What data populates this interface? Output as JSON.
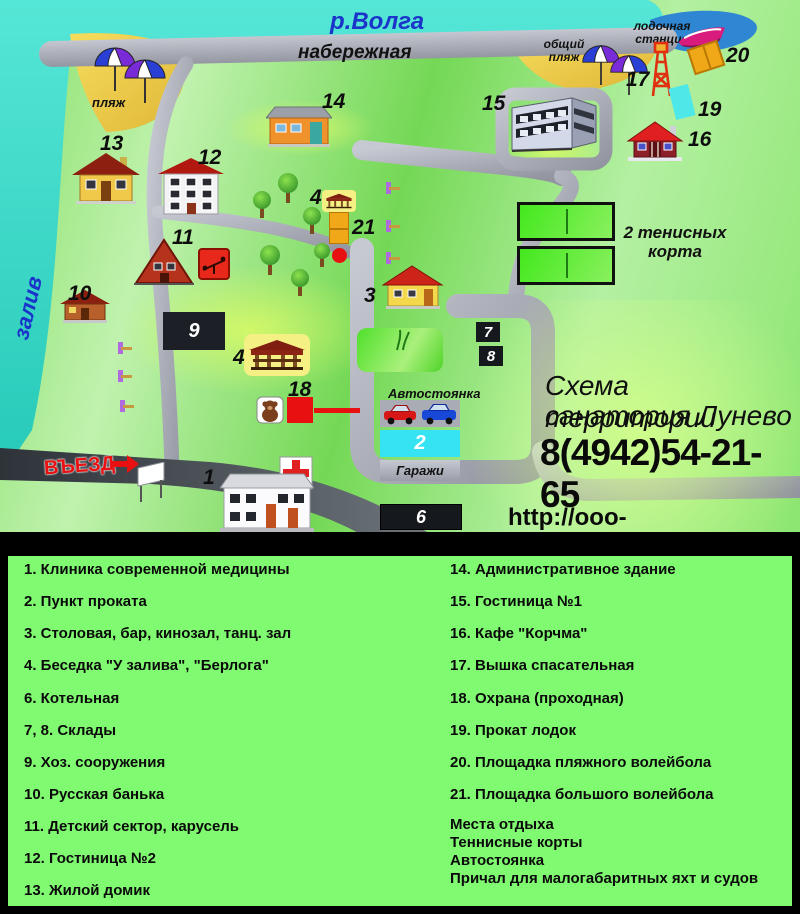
{
  "map": {
    "river": "р.Волга",
    "bay": "залив",
    "embankment": "набережная",
    "beach": "пляж",
    "public_beach": "общий пляж",
    "boat_station": "лодочная станция",
    "parking": "Автостоянка",
    "garages": "Гаражи",
    "entrance": "ВЪЕЗД",
    "tennis": "2 тенисных корта",
    "title1": "Схема территории",
    "title2": "санатория Лунево",
    "phone": "8(4942)54-21-65",
    "url": "http://ooo-sanatoriy.ru/lunevo",
    "markers": {
      "n1": "1",
      "n2": "2",
      "n3": "3",
      "n4": "4",
      "n6": "6",
      "n7": "7",
      "n8": "8",
      "n9": "9",
      "n10": "10",
      "n11": "11",
      "n12": "12",
      "n13": "13",
      "n14": "14",
      "n15": "15",
      "n16": "16",
      "n17": "17",
      "n18": "18",
      "n19": "19",
      "n20": "20",
      "n21": "21"
    },
    "colors": {
      "water": "#35d6c5",
      "bay": "#2f86d2",
      "sand": "#eecb45",
      "road": "#a8abb5",
      "accent_red": "#e81010",
      "court_orange": "#f0a818",
      "legend_green": "#80fa71"
    }
  },
  "legend": {
    "left": [
      "1. Клиника современной медицины",
      "2. Пункт проката",
      "3. Столовая, бар, кинозал, танц. зал",
      "4. Беседка  \"У залива\", \"Берлога\"",
      "6. Котельная",
      "7, 8. Склады",
      "9. Хоз. сооружения",
      "10. Русская банька",
      "11. Детский сектор, карусель",
      "12. Гостиница №2",
      "13. Жилой домик"
    ],
    "right": [
      "14. Административное здание",
      "15. Гостиница №1",
      "16. Кафе \"Корчма\"",
      "17. Вышка спасательная",
      "18. Охрана (проходная)",
      "19. Прокат лодок",
      "20. Площадка пляжного волейбола",
      "21. Площадка большого волейбола"
    ],
    "extra": [
      "Места отдыха",
      "Теннисные корты",
      "Автостоянка",
      "Причал для малогабаритных яхт и судов"
    ]
  }
}
